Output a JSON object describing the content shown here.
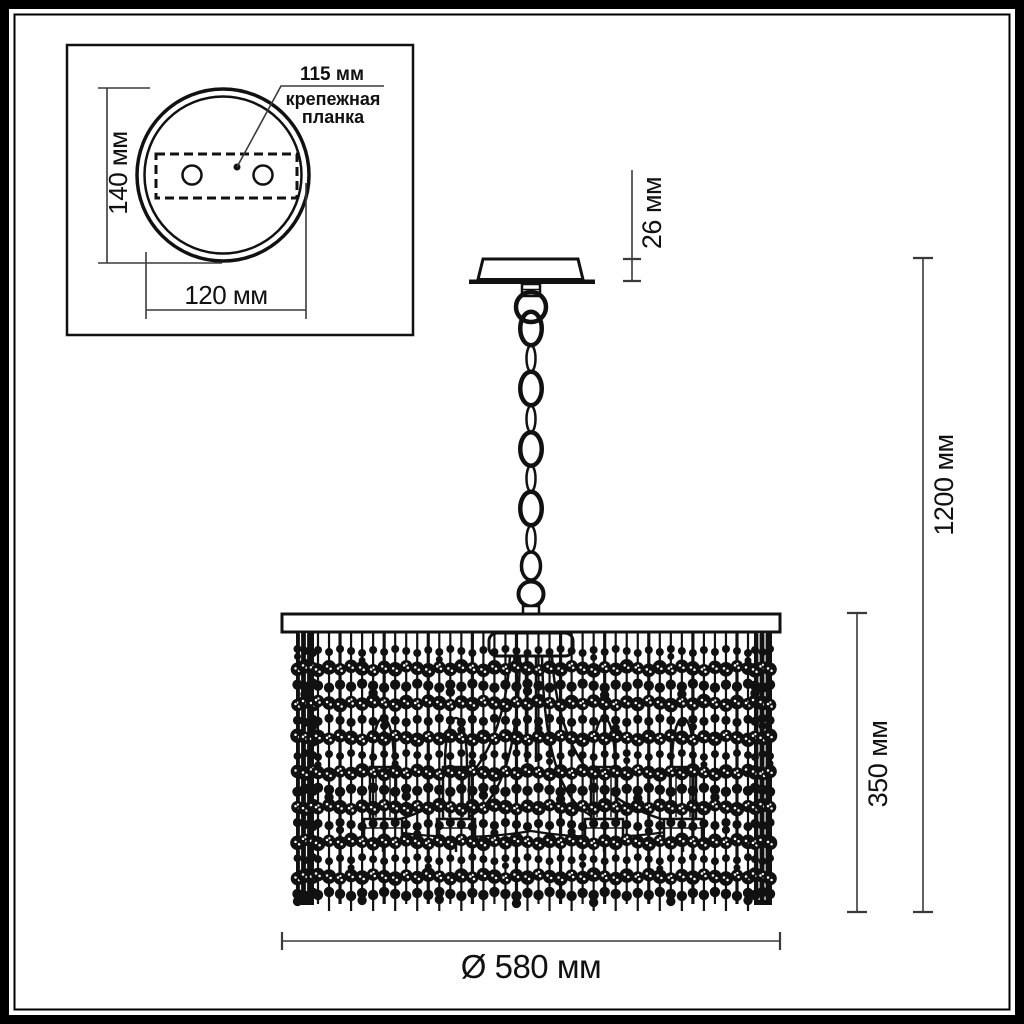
{
  "title": "Chandelier dimensional technical drawing",
  "inset": {
    "diameter_label": "140 мм",
    "width_label": "120 мм",
    "plate_offset_label": "115 мм",
    "plate_name_line1": "крепежная",
    "plate_name_line2": "планка"
  },
  "main": {
    "canopy_height_label": "26 мм",
    "overall_height_label": "1200 мм",
    "shade_height_label": "350 мм",
    "shade_diameter_label": "Ø 580 мм"
  },
  "colors": {
    "ink": "#111111",
    "dim_line": "#3a3a3a",
    "background": "#ffffff"
  }
}
